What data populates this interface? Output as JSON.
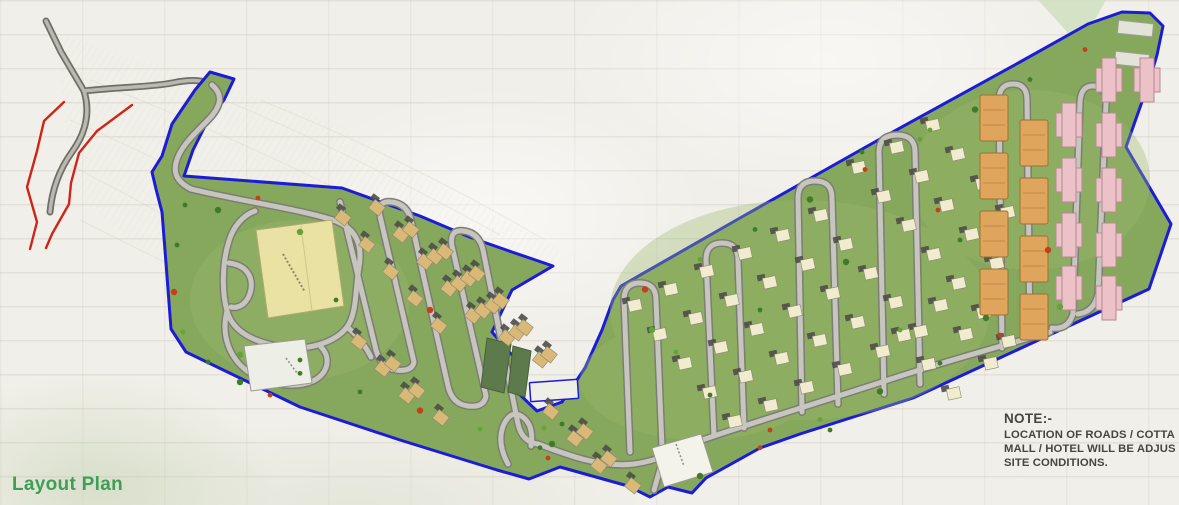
{
  "page": {
    "title": "Layout Plan",
    "title_color": "#3f9e58"
  },
  "note": {
    "heading": "NOTE:-",
    "lines": [
      "LOCATION OF ROADS / COTTA",
      "MALL / HOTEL WILL BE ADJUS",
      "SITE CONDITIONS."
    ]
  },
  "plan": {
    "colors": {
      "background": "#f1efe9",
      "site_green": "#86a85c",
      "site_green_light": "#9ab96d",
      "boundary_blue": "#1c1cd6",
      "road_fill": "#c6c6be",
      "road_casing": "#7d7d75",
      "access_road_fill": "#b9b9b1",
      "access_road_casing": "#6f6f67",
      "stream_red": "#cf2418",
      "resort_yellow": "#e9e2a3",
      "mall_white": "#edeee6",
      "cottage_tan": "#d9b878",
      "cottage_cream": "#f1ebd0",
      "roof_dark": "#4e4e48",
      "tower_orange": "#dfa55c",
      "tower_pink": "#ecc2c8",
      "pad_green": "#5d7a4c",
      "tree_green": "#3f7d24",
      "tree_green2": "#63a437",
      "tree_red": "#c2401a",
      "note_text": "#47453f"
    },
    "features": {
      "site": "site-area",
      "boundary": "site-boundary",
      "resort_building": "resort-club-building",
      "mall_building": "mall-building",
      "entrance_building": "entrance-building",
      "cottages": "cottage-plots",
      "towers": "apartment-towers",
      "streams": "stream-lines",
      "access_road": "external-access-road"
    }
  }
}
